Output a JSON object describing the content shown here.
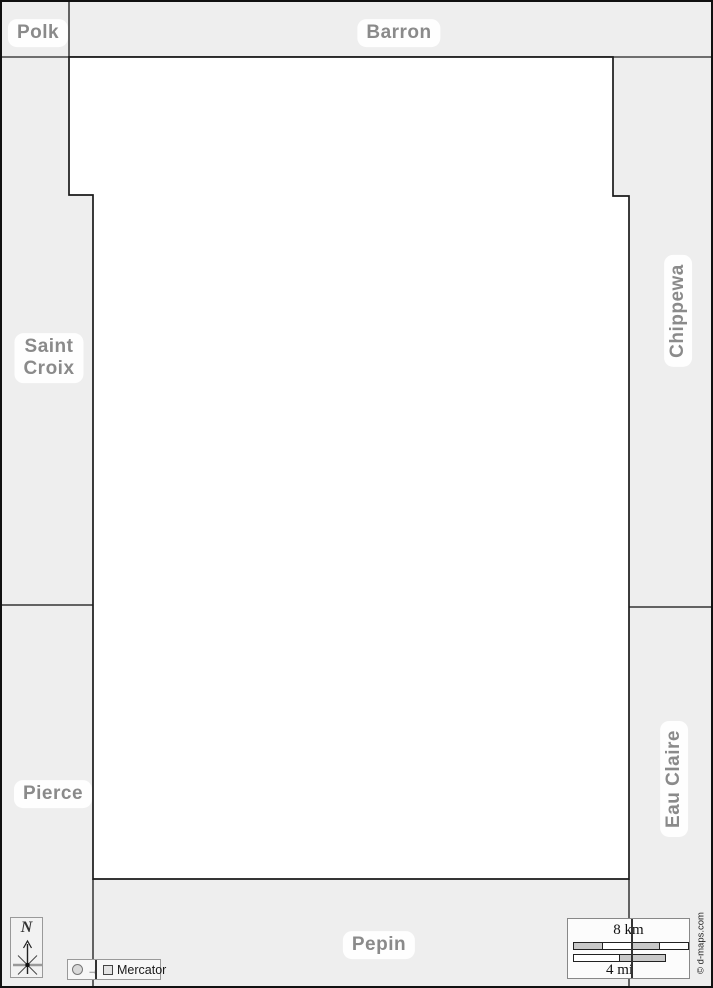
{
  "map": {
    "counties": {
      "polk": {
        "label": "Polk"
      },
      "barron": {
        "label": "Barron"
      },
      "saint_croix": {
        "label": "Saint\nCroix"
      },
      "chippewa": {
        "label": "Chippewa"
      },
      "pierce": {
        "label": "Pierce"
      },
      "eau_claire": {
        "label": "Eau Claire"
      },
      "pepin": {
        "label": "Pepin"
      }
    },
    "compass": {
      "label": "N"
    },
    "legend": {
      "projection": "Mercator",
      "arrow": "→"
    },
    "scale": {
      "km": "8 km",
      "mi": "4 mi"
    },
    "credit": "© d-maps.com",
    "colors": {
      "background": "#eeeeee",
      "map_fill": "#ffffff",
      "boundary": "#1a1a1a",
      "divider": "#444444",
      "label_text": "#8a8a8a"
    }
  }
}
